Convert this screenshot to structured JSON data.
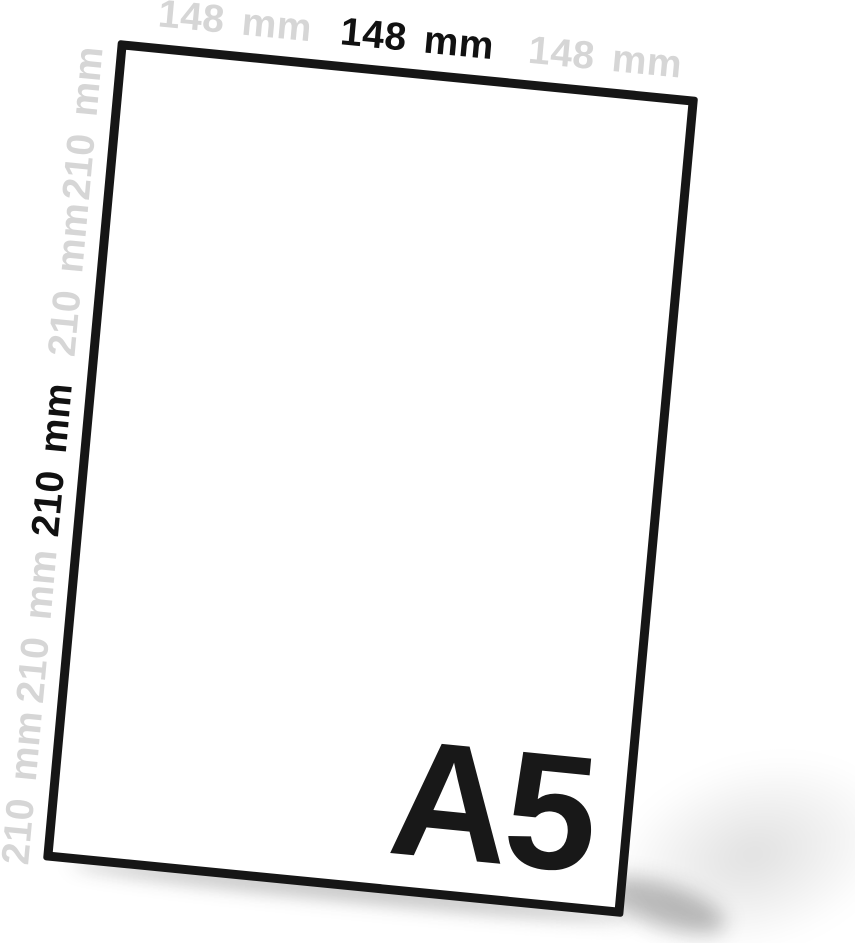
{
  "diagram": {
    "paper": {
      "size_label": "A5",
      "fill_color": "#ffffff",
      "border_color": "#161616"
    },
    "dimensions": {
      "width_value": "148 mm",
      "height_value": "210 mm",
      "top_labels": [
        {
          "text": "148 mm",
          "emphasis": "muted"
        },
        {
          "text": "148 mm",
          "emphasis": "strong"
        },
        {
          "text": "148 mm",
          "emphasis": "muted"
        }
      ],
      "left_labels": [
        {
          "text": "210 mm",
          "emphasis": "muted"
        },
        {
          "text": "210 mm",
          "emphasis": "muted"
        },
        {
          "text": "210 mm",
          "emphasis": "strong"
        },
        {
          "text": "210 mm",
          "emphasis": "muted"
        },
        {
          "text": "210 mm",
          "emphasis": "muted"
        }
      ]
    },
    "colors": {
      "strong_text": "#111111",
      "muted_text": "#d6d6d6",
      "background": "#ffffff"
    }
  }
}
